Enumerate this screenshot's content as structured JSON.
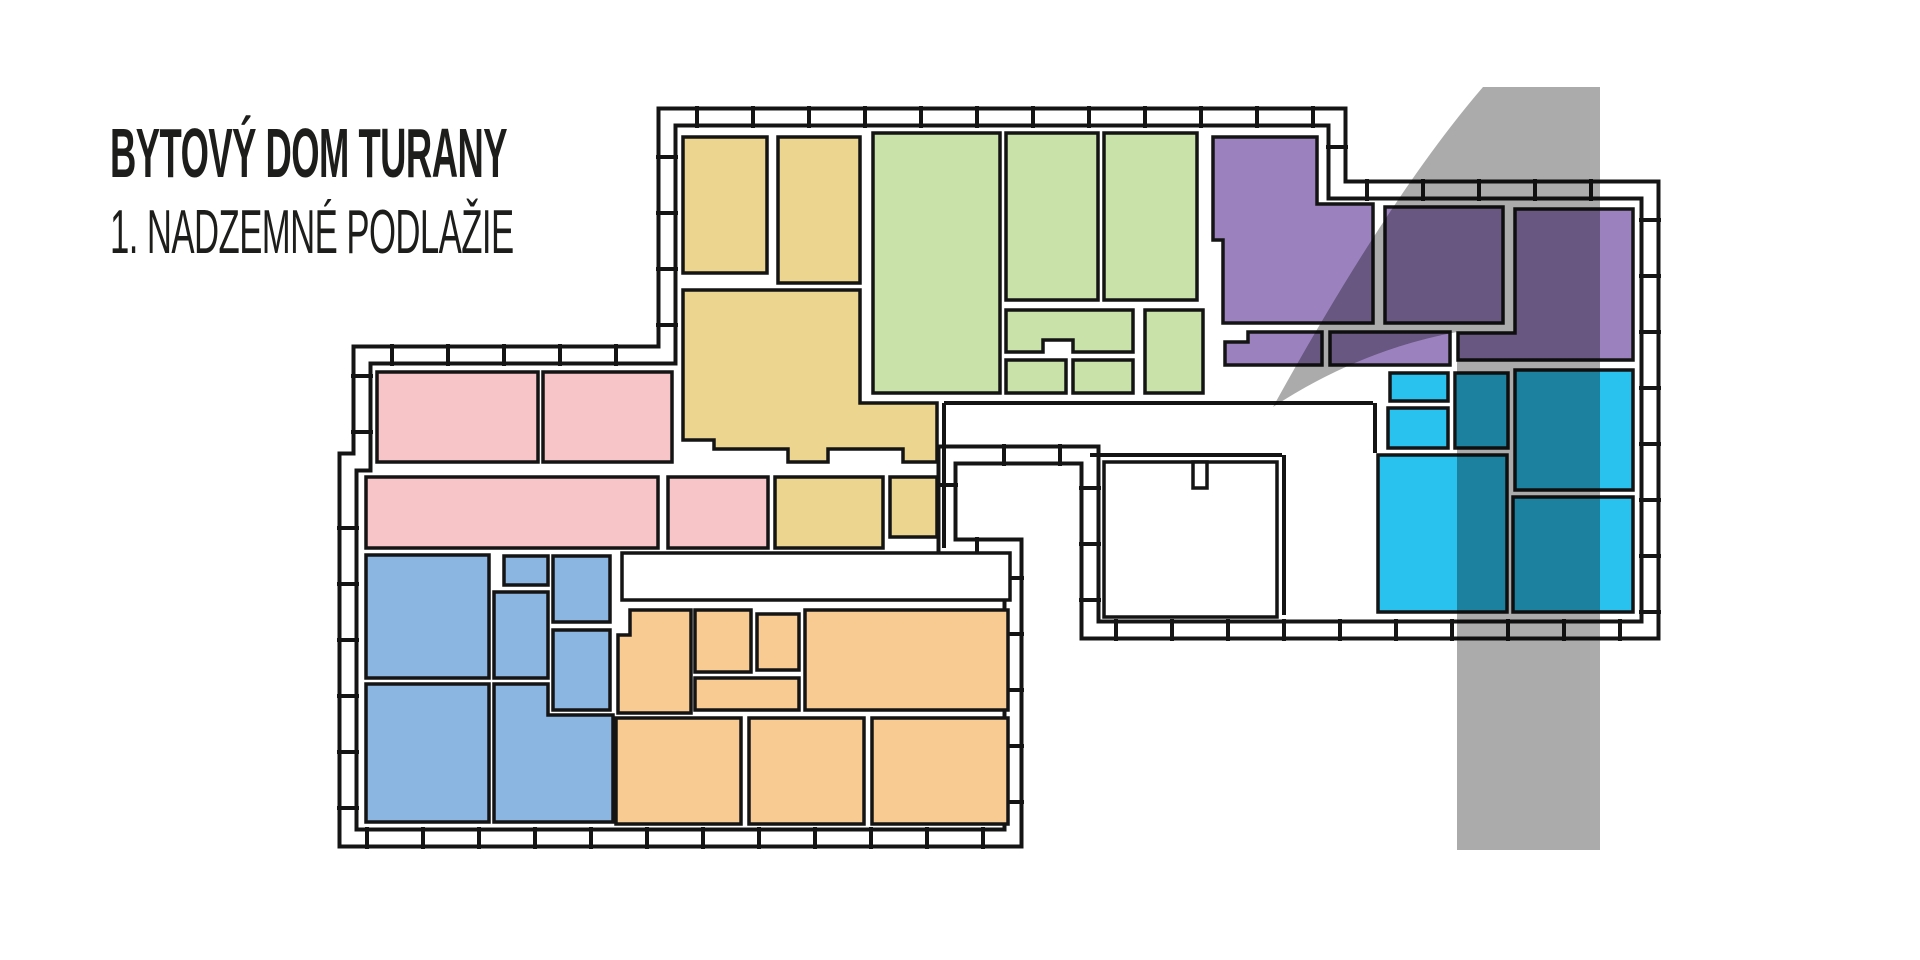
{
  "title": {
    "line1": "BYTOVÝ DOM TURANY",
    "line2": "1. NADZEMNÉ PODLAŽIE"
  },
  "floor_number": "1",
  "colors": {
    "wall": "#141414",
    "background": "#ffffff",
    "overlay_gray": "#ababab",
    "yellow": "#ecd68f",
    "green": "#c8e2a9",
    "purple": "#9b82bf",
    "pink": "#f7c5c7",
    "blue": "#8ab6e1",
    "orange": "#f8cb93",
    "cyan": "#29c1ee"
  },
  "plan": {
    "outer_boundary": [
      [
        667,
        117
      ],
      [
        1337,
        117
      ],
      [
        1337,
        190
      ],
      [
        1650,
        190
      ],
      [
        1650,
        630
      ],
      [
        1090,
        630
      ],
      [
        1090,
        455
      ],
      [
        947,
        455
      ],
      [
        947,
        548
      ],
      [
        1013,
        548
      ],
      [
        1013,
        838
      ],
      [
        348,
        838
      ],
      [
        348,
        462
      ],
      [
        362,
        462
      ],
      [
        362,
        355
      ],
      [
        667,
        355
      ]
    ],
    "band": {
      "outer_width": 21,
      "inner_width": 13,
      "tick_width": 4,
      "tick_spacing": 56,
      "tick_length": 22
    },
    "wall_segments": [
      [
        944,
        403,
        944,
        548
      ],
      [
        944,
        403,
        1373,
        403
      ],
      [
        1375,
        403,
        1375,
        453
      ],
      [
        1090,
        455,
        1282,
        455
      ],
      [
        1284,
        455,
        1284,
        615
      ]
    ],
    "white_rooms": [
      {
        "id": "corridor-room",
        "rect": [
          622,
          553,
          388,
          47
        ]
      },
      {
        "id": "staircase-room",
        "rect": [
          1104,
          462,
          173,
          155
        ]
      },
      {
        "id": "staircase-wall-stub",
        "rect": [
          1193,
          462,
          14,
          26
        ]
      }
    ],
    "apartments": [
      {
        "id": "unit-yellow",
        "color": "yellow",
        "rooms": [
          {
            "rect": [
              683,
              137,
              84,
              136
            ]
          },
          {
            "rect": [
              778,
              137,
              82,
              146
            ]
          },
          {
            "poly": [
              [
                683,
                290
              ],
              [
                860,
                290
              ],
              [
                860,
                403
              ],
              [
                937,
                403
              ],
              [
                937,
                462
              ],
              [
                903,
                462
              ],
              [
                903,
                449
              ],
              [
                828,
                449
              ],
              [
                828,
                462
              ],
              [
                788,
                462
              ],
              [
                788,
                449
              ],
              [
                714,
                449
              ],
              [
                714,
                440
              ],
              [
                683,
                440
              ]
            ]
          },
          {
            "rect": [
              775,
              477,
              108,
              71
            ]
          },
          {
            "rect": [
              890,
              477,
              47,
              60
            ]
          }
        ]
      },
      {
        "id": "unit-green",
        "color": "green",
        "rooms": [
          {
            "rect": [
              873,
              133,
              127,
              260
            ]
          },
          {
            "rect": [
              1006,
              133,
              92,
              167
            ]
          },
          {
            "rect": [
              1104,
              133,
              93,
              167
            ]
          },
          {
            "poly": [
              [
                1006,
                310
              ],
              [
                1133,
                310
              ],
              [
                1133,
                352
              ],
              [
                1073,
                352
              ],
              [
                1073,
                340
              ],
              [
                1043,
                340
              ],
              [
                1043,
                352
              ],
              [
                1006,
                352
              ]
            ]
          },
          {
            "rect": [
              1006,
              360,
              60,
              33
            ]
          },
          {
            "rect": [
              1073,
              360,
              60,
              33
            ]
          },
          {
            "rect": [
              1145,
              310,
              58,
              83
            ]
          }
        ]
      },
      {
        "id": "unit-purple",
        "color": "purple",
        "rooms": [
          {
            "poly": [
              [
                1213,
                137
              ],
              [
                1317,
                137
              ],
              [
                1317,
                204
              ],
              [
                1373,
                204
              ],
              [
                1373,
                323
              ],
              [
                1223,
                323
              ],
              [
                1223,
                240
              ],
              [
                1213,
                240
              ]
            ]
          },
          {
            "rect": [
              1385,
              207,
              118,
              116
            ]
          },
          {
            "poly": [
              [
                1515,
                209
              ],
              [
                1633,
                209
              ],
              [
                1633,
                360
              ],
              [
                1458,
                360
              ],
              [
                1458,
                333
              ],
              [
                1515,
                333
              ]
            ]
          },
          {
            "poly": [
              [
                1248,
                332
              ],
              [
                1322,
                332
              ],
              [
                1322,
                365
              ],
              [
                1225,
                365
              ],
              [
                1225,
                342
              ],
              [
                1248,
                342
              ]
            ]
          },
          {
            "rect": [
              1330,
              332,
              120,
              33
            ]
          }
        ]
      },
      {
        "id": "unit-cyan",
        "color": "cyan",
        "rooms": [
          {
            "rect": [
              1390,
              373,
              58,
              28
            ]
          },
          {
            "rect": [
              1388,
              408,
              60,
              40
            ]
          },
          {
            "rect": [
              1455,
              373,
              53,
              75
            ]
          },
          {
            "rect": [
              1515,
              370,
              118,
              120
            ]
          },
          {
            "rect": [
              1378,
              455,
              129,
              157
            ]
          },
          {
            "rect": [
              1513,
              497,
              120,
              115
            ]
          }
        ]
      },
      {
        "id": "unit-pink",
        "color": "pink",
        "rooms": [
          {
            "rect": [
              377,
              372,
              161,
              90
            ]
          },
          {
            "rect": [
              543,
              372,
              129,
              90
            ]
          },
          {
            "rect": [
              366,
              477,
              292,
              71
            ]
          },
          {
            "rect": [
              668,
              477,
              100,
              71
            ]
          }
        ]
      },
      {
        "id": "unit-blue",
        "color": "blue",
        "rooms": [
          {
            "rect": [
              366,
              555,
              123,
              123
            ]
          },
          {
            "rect": [
              504,
              556,
              44,
              29
            ]
          },
          {
            "rect": [
              494,
              592,
              54,
              86
            ]
          },
          {
            "rect": [
              553,
              556,
              57,
              66
            ]
          },
          {
            "rect": [
              553,
              630,
              57,
              80
            ]
          },
          {
            "rect": [
              366,
              684,
              123,
              138
            ]
          },
          {
            "poly": [
              [
                494,
                684
              ],
              [
                548,
                684
              ],
              [
                548,
                715
              ],
              [
                613,
                715
              ],
              [
                613,
                822
              ],
              [
                494,
                822
              ]
            ]
          }
        ]
      },
      {
        "id": "unit-orange",
        "color": "orange",
        "rooms": [
          {
            "poly": [
              [
                630,
                610
              ],
              [
                691,
                610
              ],
              [
                691,
                713
              ],
              [
                618,
                713
              ],
              [
                618,
                635
              ],
              [
                630,
                635
              ]
            ]
          },
          {
            "rect": [
              695,
              610,
              56,
              62
            ]
          },
          {
            "rect": [
              757,
              614,
              42,
              56
            ]
          },
          {
            "rect": [
              805,
              610,
              203,
              100
            ]
          },
          {
            "rect": [
              695,
              678,
              104,
              32
            ]
          },
          {
            "rect": [
              616,
              718,
              125,
              106
            ]
          },
          {
            "rect": [
              749,
              718,
              115,
              106
            ]
          },
          {
            "rect": [
              872,
              718,
              136,
              106
            ]
          }
        ]
      }
    ],
    "overlay_numeral": {
      "glyph": "1",
      "path": "M 1600,87 L 1600,850 L 1457,850 L 1457,332 Q 1360,350 1273,407 Q 1390,195 1483,87 Z"
    }
  }
}
